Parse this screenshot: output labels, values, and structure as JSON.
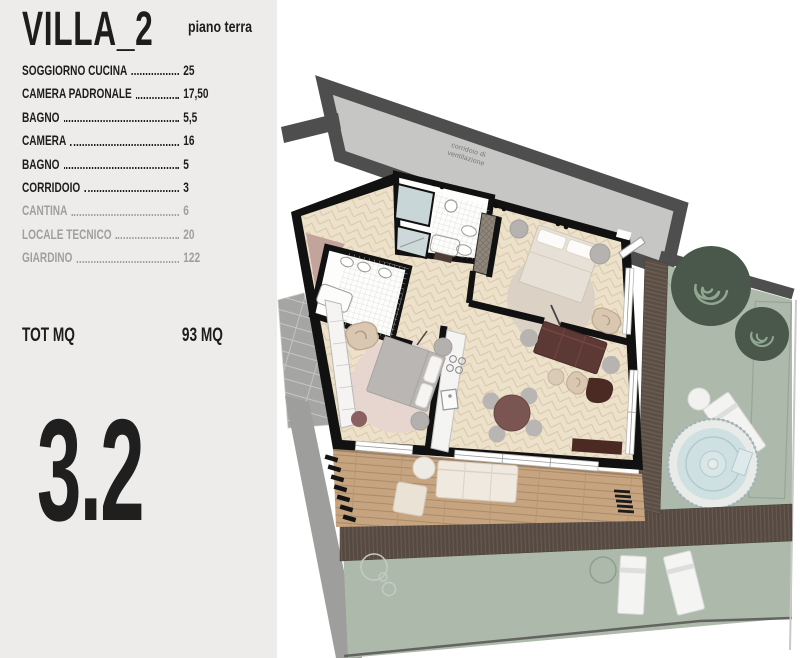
{
  "panel": {
    "title": "VILLA_2",
    "subtitle": "piano terra",
    "rooms": [
      {
        "label": "SOGGIORNO CUCINA",
        "value": "25",
        "muted": false
      },
      {
        "label": "CAMERA PADRONALE",
        "value": "17,50",
        "muted": false
      },
      {
        "label": "BAGNO",
        "value": "5,5",
        "muted": false
      },
      {
        "label": "CAMERA",
        "value": "16",
        "muted": false
      },
      {
        "label": "BAGNO",
        "value": "5",
        "muted": false
      },
      {
        "label": "CORRIDOIO",
        "value": "3",
        "muted": false
      },
      {
        "label": "CANTINA",
        "value": "6",
        "muted": true
      },
      {
        "label": "LOCALE TECNICO",
        "value": "20",
        "muted": true
      },
      {
        "label": "GIARDINO",
        "value": "122",
        "muted": true
      }
    ],
    "total_label": "TOT MQ",
    "total_value": "93 MQ",
    "unit_number": "3.2"
  },
  "plan": {
    "corridor_label_line1": "corridoio di",
    "corridor_label_line2": "ventilazione",
    "colors": {
      "panel_bg": "#edecea",
      "walls": "#111111",
      "corridor_fill": "#c6c6c5",
      "corridor_wall": "#4e4e4e",
      "garden_green": "#adbaab",
      "bush_green": "#49584a",
      "deck_brown": "#554941",
      "terrace_wood": "#c6a480",
      "floor_beige": "#ece1cb",
      "sofa_maroon": "#5d3936",
      "hot_tub_water": "#cfe0e2"
    }
  }
}
